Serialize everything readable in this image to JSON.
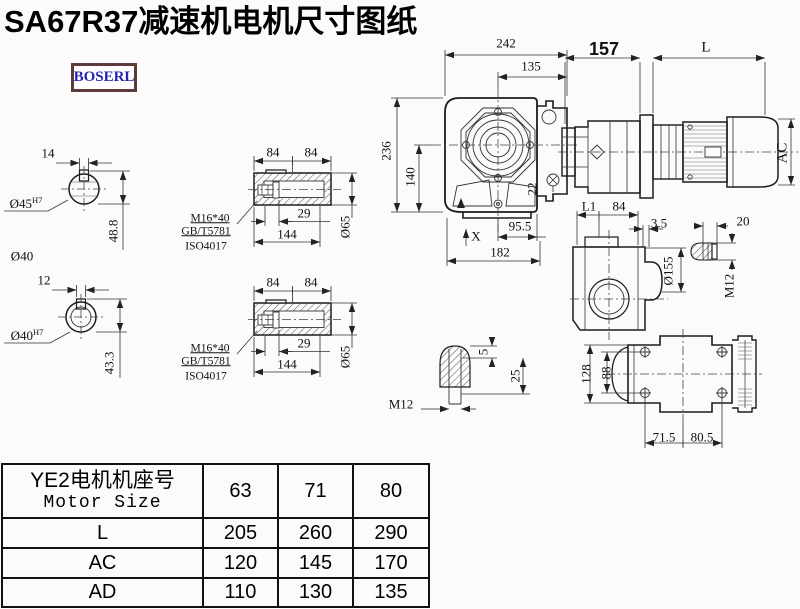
{
  "page": {
    "title": "SA67R37减速机电机尺寸图纸",
    "logo": "BOSERL"
  },
  "fig_shaft_top": {
    "keyway_width": "14",
    "bore": "Ø45",
    "bore_tol": "H7",
    "keyway_depth": "48.8",
    "hub": "Ø40"
  },
  "fig_shaft_bottom": {
    "keyway_width": "12",
    "bore": "Ø40",
    "bore_tol": "H7",
    "keyway_depth": "43.3"
  },
  "fig_hollow_top": {
    "half_len_a": "84",
    "half_len_b": "84",
    "bolt": "M16*40",
    "std_gb": "GB/T5781",
    "std_iso": "ISO4017",
    "thread_depth": "29",
    "total_len": "144",
    "dia": "Ø65"
  },
  "fig_hollow_bottom": {
    "half_len_a": "84",
    "half_len_b": "84",
    "bolt": "M16*40",
    "std_gb": "GB/T5781",
    "std_iso": "ISO4017",
    "thread_depth": "29",
    "total_len": "144",
    "dia": "Ø65"
  },
  "fig_front": {
    "width": "242",
    "center_to_edge": "135",
    "height": "236",
    "center_to_base": "140",
    "rib": "22",
    "foot_offset": "95.5",
    "mark": "X",
    "base_len": "182"
  },
  "fig_motor": {
    "gear_len": "157",
    "motor_len": "L",
    "motor_dia": "AC"
  },
  "fig_side": {
    "l1": "L1",
    "half_len": "84",
    "gap": "3.5",
    "flange_dia": "Ø155",
    "stud_len": "20",
    "stud_thread": "M12"
  },
  "fig_plug": {
    "proj": "5",
    "depth": "25",
    "thread": "M12"
  },
  "fig_top": {
    "width": "128",
    "bolt_span": "88",
    "foot_a": "71.5",
    "foot_b": "80.5"
  },
  "table": {
    "header_line1": "YE2电机机座号",
    "header_line2": "Motor Size",
    "sizes": [
      "63",
      "71",
      "80"
    ],
    "rows": [
      {
        "label": "L",
        "values": [
          "205",
          "260",
          "290"
        ]
      },
      {
        "label": "AC",
        "values": [
          "120",
          "145",
          "170"
        ]
      },
      {
        "label": "AD",
        "values": [
          "110",
          "130",
          "135"
        ]
      }
    ]
  }
}
